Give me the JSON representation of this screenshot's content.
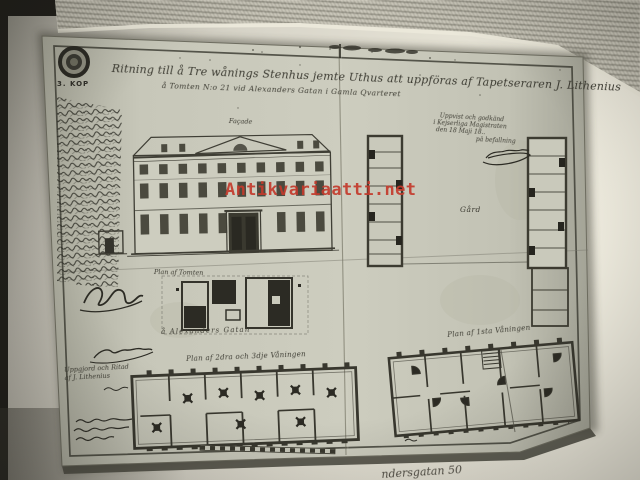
{
  "photo": {
    "watermark_text": "Antikvariaatti.net",
    "caption_fragment": "ndersgatan 50"
  },
  "plate": {
    "stamp_value": "3. KOP",
    "title_line1": "Ritning till å Tre wånings Stenhus jemte Uthus att uppföras af Tapetseraren J. Lithenius",
    "title_line2": "å Tomten N:o 21 vid Alexanders Gatan i Gamla Qvarteret",
    "facade_label": "Façade",
    "courtyard_label": "Gård",
    "site_plan_label": "Plan af Tomten",
    "street_label": "å Alexanders Gatan",
    "upper_plan_label": "Plan af 2dra och 3dje Våningen",
    "ground_plan_label": "Plan af 1sta Våningen",
    "approval": {
      "line1": "Uppvist och godkänd",
      "line2": "i Kejserliga Magistraten",
      "line3": "den 18 Maji 18..",
      "on_command": "på befallning"
    },
    "credit": {
      "line1": "Uppgjord och Ritad",
      "line2": "af J. Lithenius"
    }
  },
  "colors": {
    "watermark_red": "#c43a2c",
    "plate_paper": "#c9c9bb",
    "page_cream": "#e6e3d6",
    "ink": "#35342c",
    "background_dark": "#201f1a"
  }
}
